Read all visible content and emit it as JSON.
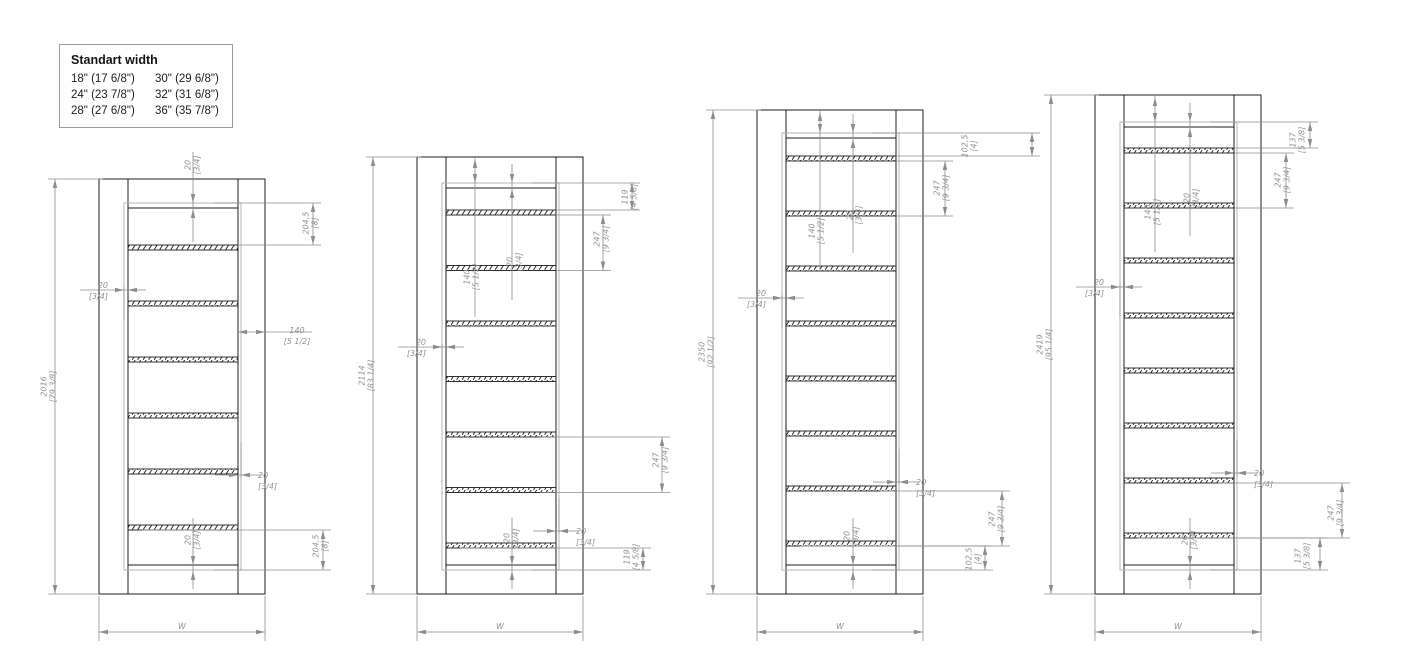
{
  "legend": {
    "title": "Standart width",
    "rows": [
      [
        "18\" (17 6/8\")",
        "30\" (29 6/8\")"
      ],
      [
        "24\" (23 7/8\")",
        "32\" (31 6/8\")"
      ],
      [
        "28\" (27 6/8\")",
        "36\" (35 7/8\")"
      ]
    ]
  },
  "drawings": [
    {
      "id": "elevation-2016",
      "height_mm": "2016",
      "height_in": "[79 3/8]",
      "width_label": "W",
      "shelf_count": 6,
      "top_rail": {
        "mm": "20",
        "in": "[3/4]"
      },
      "top_gap": {
        "mm": "204,5",
        "in": "[8]"
      },
      "frame_width": {
        "mm": "140",
        "in": "[5 1/2]"
      },
      "side_clearance": {
        "mm": "20",
        "in": "[3/4]"
      },
      "edge_gap": {
        "mm": "20",
        "in": "[3/4]"
      },
      "bottom_gap": {
        "mm": "204,5",
        "in": "[8]"
      },
      "bottom_rail": {
        "mm": "20",
        "in": "[3/4]"
      }
    },
    {
      "id": "elevation-2114",
      "height_mm": "2114",
      "height_in": "[83 1/4]",
      "width_label": "W",
      "shelf_count": 7,
      "top_rail": {
        "mm": "20",
        "in": "[3/4]"
      },
      "top_gap": {
        "mm": "119",
        "in": "[4 5/8]"
      },
      "frame_width": {
        "mm": "140",
        "in": "[5 1/2]"
      },
      "shelf_pitch": {
        "mm": "247",
        "in": "[9 3/4]"
      },
      "side_clearance": {
        "mm": "20",
        "in": "[3/4]"
      },
      "edge_gap": {
        "mm": "20",
        "in": "[3/4]"
      },
      "bottom_gap": {
        "mm": "119",
        "in": "[4 5/8]"
      },
      "bottom_rail": {
        "mm": "20",
        "in": "[3/4]"
      }
    },
    {
      "id": "elevation-2350",
      "height_mm": "2350",
      "height_in": "[92 1/2]",
      "width_label": "W",
      "shelf_count": 8,
      "top_rail": {
        "mm": "20",
        "in": "[3/4]"
      },
      "top_gap": {
        "mm": "102,5",
        "in": "[4]"
      },
      "frame_width": {
        "mm": "140",
        "in": "[5 1/2]"
      },
      "shelf_pitch": {
        "mm": "247",
        "in": "[9 3/4]"
      },
      "side_clearance": {
        "mm": "20",
        "in": "[3/4]"
      },
      "edge_gap": {
        "mm": "20",
        "in": "[3/4]"
      },
      "bottom_gap": {
        "mm": "102,5",
        "in": "[4]"
      },
      "bottom_rail": {
        "mm": "20",
        "in": "[3/4]"
      }
    },
    {
      "id": "elevation-2419",
      "height_mm": "2419",
      "height_in": "[95 1/4]",
      "width_label": "W",
      "shelf_count": 8,
      "top_rail": {
        "mm": "20",
        "in": "[3/4]"
      },
      "top_gap": {
        "mm": "137",
        "in": "[5 3/8]"
      },
      "frame_width": {
        "mm": "140",
        "in": "[5 1/2]"
      },
      "shelf_pitch": {
        "mm": "247",
        "in": "[9 3/4]"
      },
      "side_clearance": {
        "mm": "20",
        "in": "[3/4]"
      },
      "edge_gap": {
        "mm": "20",
        "in": "[3/4]"
      },
      "bottom_gap": {
        "mm": "137",
        "in": "[5 3/8]"
      },
      "bottom_rail": {
        "mm": "20",
        "in": "[3/4]"
      }
    }
  ]
}
